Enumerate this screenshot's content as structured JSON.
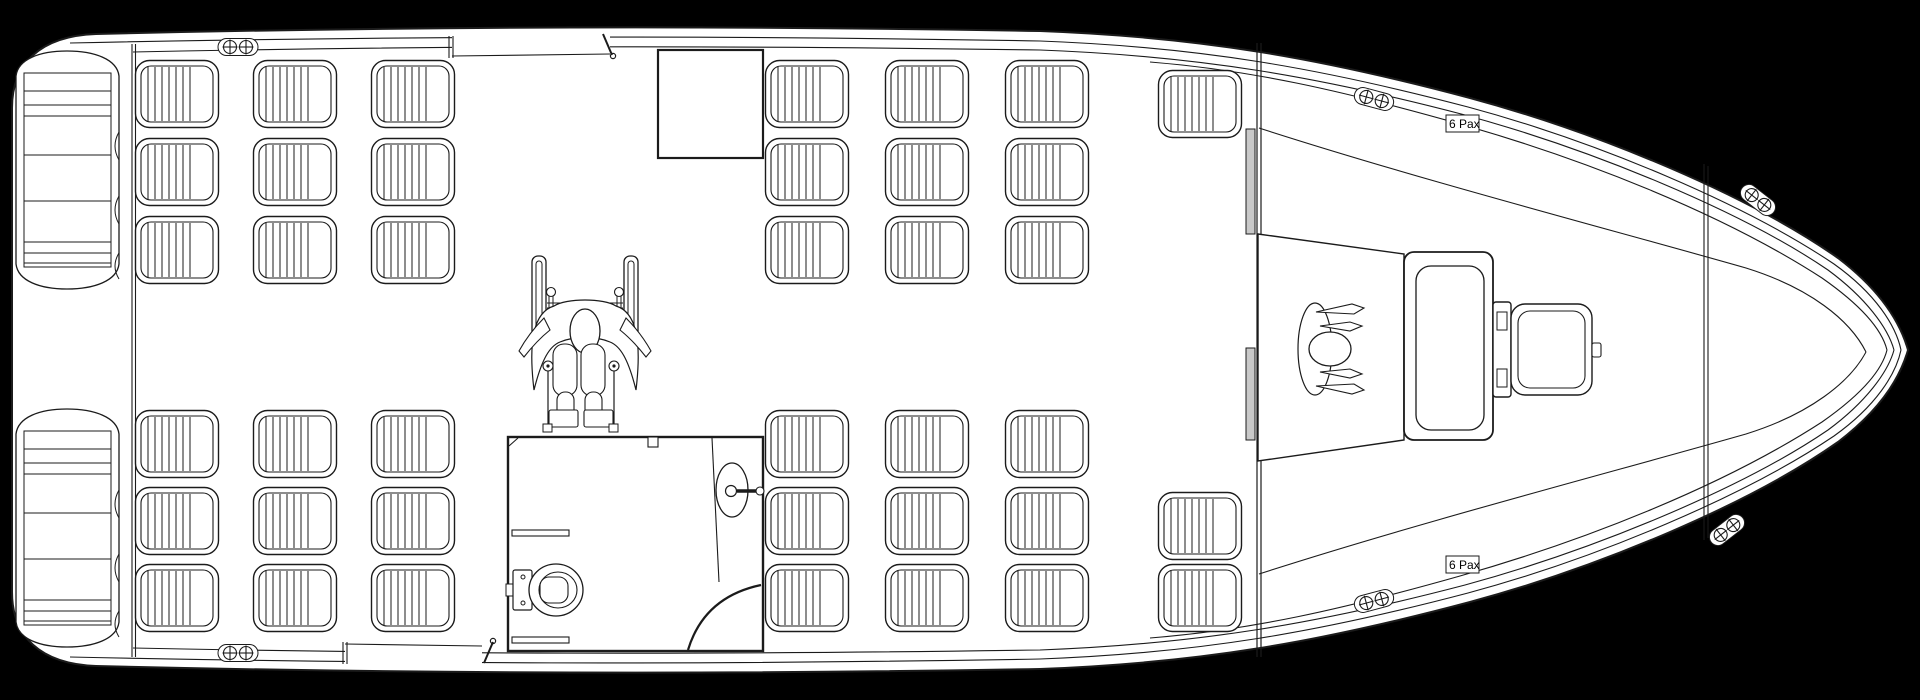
{
  "drawing": {
    "kind": "vessel-deck-plan",
    "orientation": "bow-right"
  },
  "labels": {
    "bow_capacity_top": "6 Pax",
    "bow_capacity_bottom": "6 Pax"
  },
  "colors": {
    "background": "#000000",
    "hull": "#ffffff",
    "line": "#1b1b1b",
    "door_panel": "#c9c9c9"
  },
  "seats": {
    "unit_w": 84,
    "unit_h": 68,
    "groups": [
      {
        "name": "port-aft",
        "x": 135,
        "y": 60,
        "cols": 3,
        "rows": 3,
        "dx": 118,
        "dy": 78
      },
      {
        "name": "starboard-aft",
        "x": 135,
        "y": 410,
        "cols": 3,
        "rows": 3,
        "dx": 118,
        "dy": 77
      },
      {
        "name": "port-mid",
        "x": 765,
        "y": 60,
        "cols": 3,
        "rows": 3,
        "dx": 120,
        "dy": 78
      },
      {
        "name": "starboard-mid",
        "x": 765,
        "y": 410,
        "cols": 3,
        "rows": 3,
        "dx": 120,
        "dy": 77
      },
      {
        "name": "port-forward",
        "x": 1158,
        "y": 70,
        "cols": 1,
        "rows": 1,
        "dx": 0,
        "dy": 0
      },
      {
        "name": "starboard-forward",
        "x": 1158,
        "y": 492,
        "cols": 1,
        "rows": 2,
        "dx": 0,
        "dy": 72
      }
    ]
  },
  "benches": [
    {
      "name": "stern-bench-port",
      "x": 10,
      "y": 46
    },
    {
      "name": "stern-bench-starboard",
      "x": 10,
      "y": 404
    }
  ],
  "cleats": [
    {
      "x": 238,
      "y": 47,
      "r": 0
    },
    {
      "x": 238,
      "y": 653,
      "r": 0
    },
    {
      "x": 1374,
      "y": 99,
      "r": 15
    },
    {
      "x": 1374,
      "y": 601,
      "r": -15
    },
    {
      "x": 1758,
      "y": 200,
      "r": 38
    },
    {
      "x": 1727,
      "y": 530,
      "r": -38
    }
  ]
}
